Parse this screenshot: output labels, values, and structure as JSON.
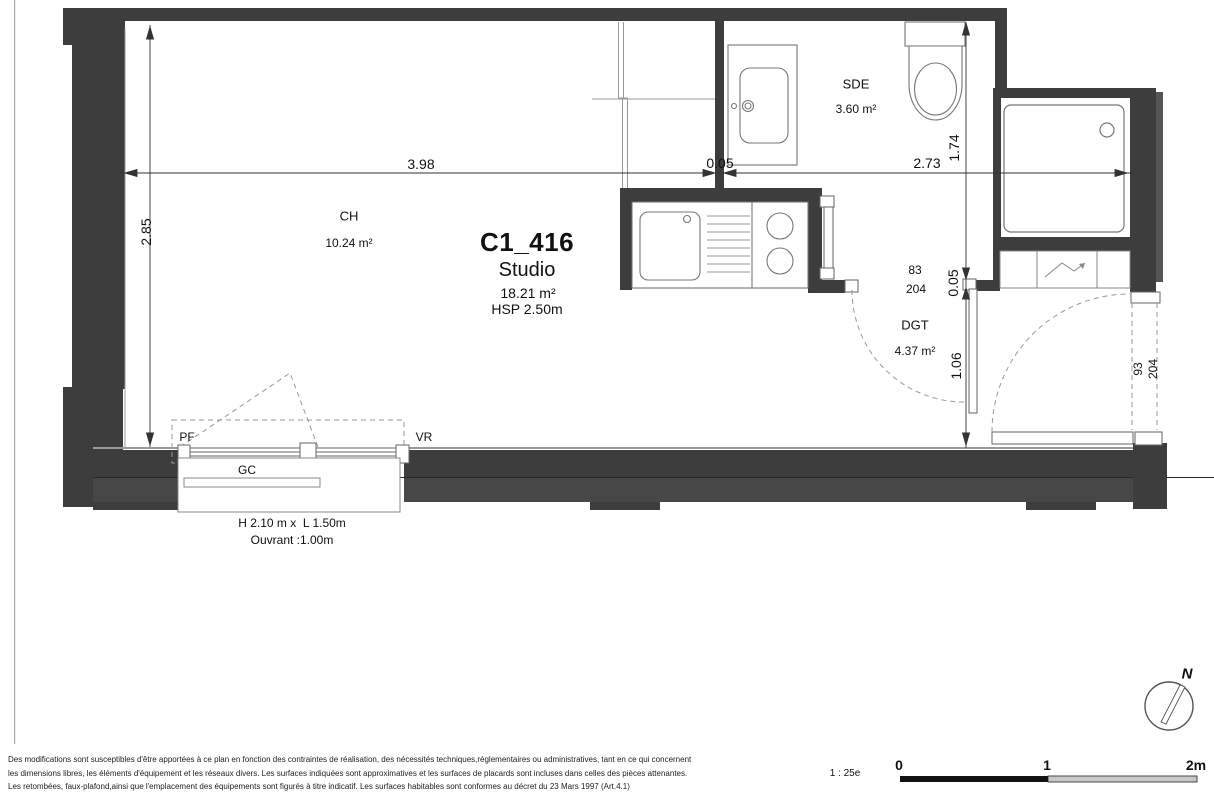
{
  "header": {
    "unit_id": "C1_416",
    "type": "Studio",
    "area": "18.21 m²",
    "ceiling_height": "HSP 2.50m"
  },
  "rooms": {
    "ch": {
      "name": "CH",
      "area": "10.24 m²"
    },
    "sde": {
      "name": "SDE",
      "area": "3.60 m²"
    },
    "dgt": {
      "name": "DGT",
      "area": "4.37 m²"
    }
  },
  "dims": {
    "ch_width": "3.98",
    "partition_a": "0.05",
    "right_width": "2.73",
    "sde_depth": "1.74",
    "ch_depth": "2.85",
    "partition_b": "0.05",
    "entry_depth": "1.06"
  },
  "doors": {
    "sde": {
      "width": "83",
      "height": "204"
    },
    "entry": {
      "width": "93",
      "height": "204"
    }
  },
  "window": {
    "pf": "PF",
    "vr": "VR",
    "gc": "GC",
    "size": "H 2.10 m x  L 1.50m",
    "opening": "Ouvrant :1.00m"
  },
  "compass": {
    "north": "N"
  },
  "scalebar": {
    "ratio": "1 : 25e",
    "tick0": "0",
    "tick1": "1",
    "tick2": "2m"
  },
  "colors": {
    "wall": "#3d3d3d",
    "wall2": "#474747",
    "line": "#888888",
    "accent": "#111111"
  },
  "disclaimer": {
    "line1": "Des modifications sont susceptibles d'être apportées à ce plan en fonction des contraintes de réalisation, des nécessités techniques,réglementaires ou administratives, tant en ce qui concernent",
    "line2": "les dimensions libres, les éléments d'équipement et les réseaux divers. Les surfaces indiquées sont approximatives et les surfaces de placards sont incluses dans celles des pièces attenantes.",
    "line3": "Les retombées, faux-plafond,ainsi que l'emplacement des équipements sont figurés à titre indicatif. Les surfaces habitables sont conformes au décret du 23 Mars 1997 (Art.4.1)"
  }
}
